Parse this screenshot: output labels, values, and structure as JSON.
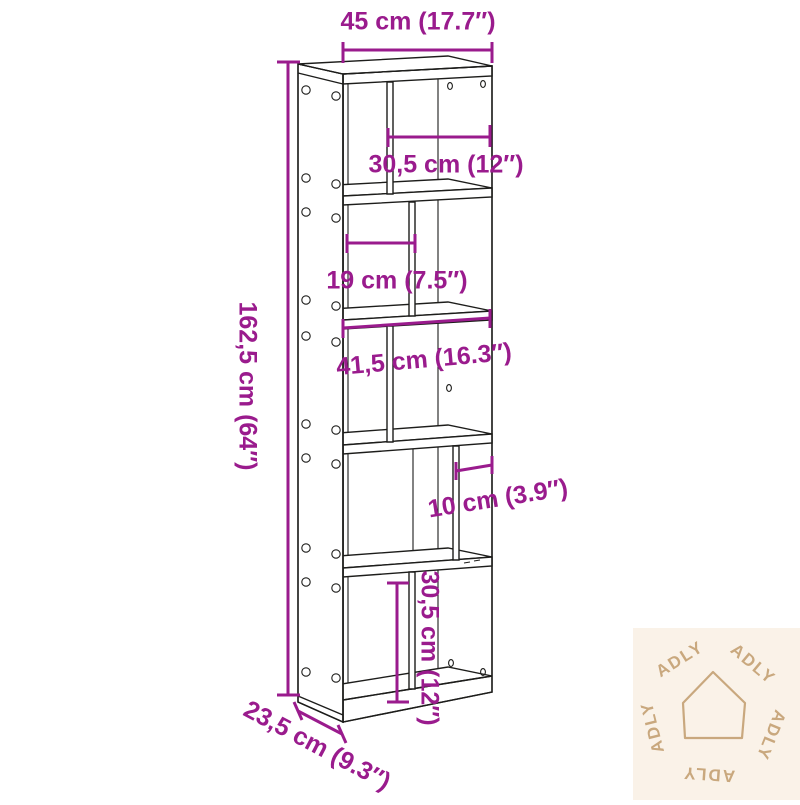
{
  "diagram": {
    "product_name": "5-tier bookcase dimension drawing",
    "line_color": "#1d1d1b",
    "dimension_color": "#9a1b8d",
    "labels": {
      "width": "45 cm (17.7″)",
      "tier1_opening_width": "30,5 cm (12″)",
      "tier2_opening_width": "19 cm (7.5″)",
      "tier3_interior_width": "41,5 cm (16.3″)",
      "tier4_gap_width": "10 cm (3.9″)",
      "tier5_opening_height": "30,5 cm (12″)",
      "total_height": "162,5 cm (64″)",
      "depth": "23,5 cm (9.3″)"
    }
  },
  "watermark": {
    "brand": "ADLY",
    "background": "#faf2e8",
    "accent": "#c9a87e"
  }
}
